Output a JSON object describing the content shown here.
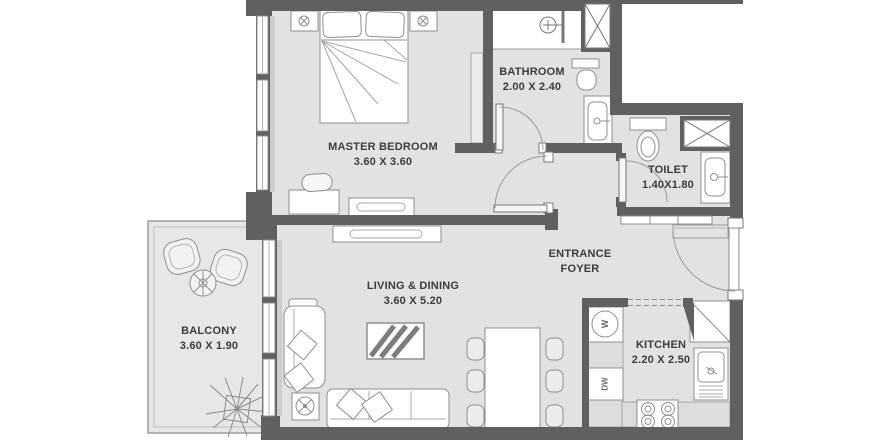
{
  "plan": {
    "type": "apartment-floor-plan",
    "rooms": [
      {
        "id": "master-bedroom",
        "lines": [
          "MASTER BEDROOM",
          "3.60 X 3.60"
        ]
      },
      {
        "id": "bathroom",
        "lines": [
          "BATHROOM",
          "2.00 X 2.40"
        ]
      },
      {
        "id": "toilet",
        "lines": [
          "TOILET",
          "1.40X1.80"
        ]
      },
      {
        "id": "entrance-foyer",
        "lines": [
          "ENTRANCE",
          "FOYER"
        ]
      },
      {
        "id": "living-dining",
        "lines": [
          "LIVING & DINING",
          "3.60 X 5.20"
        ]
      },
      {
        "id": "kitchen",
        "lines": [
          "KITCHEN",
          "2.20 X 2.50"
        ]
      },
      {
        "id": "balcony",
        "lines": [
          "BALCONY",
          "3.60 X 1.90"
        ]
      }
    ],
    "appliances": {
      "washer_label": "W",
      "dishwasher_label": "DW"
    },
    "colors": {
      "wall": "#606060",
      "floor": "#e2e2e2",
      "balcony_floor": "#e7e7e7",
      "furniture_outline": "#8f8f8f",
      "text": "#3c3c3c",
      "background": "#ffffff"
    }
  }
}
